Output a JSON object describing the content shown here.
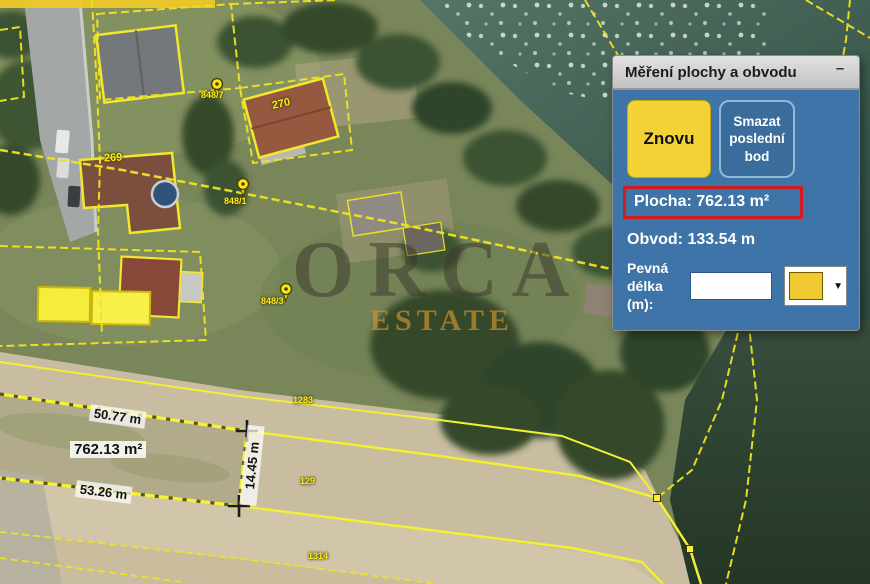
{
  "panel": {
    "title": "Měření plochy a obvodu",
    "minimize": "–",
    "again_button": "Znovu",
    "delete_button": "Smazat poslední bod",
    "area_text": "Plocha: 762.13 m²",
    "perimeter_text": "Obvod: 133.54 m",
    "fixed_length_label": "Pevná délka (m):",
    "fixed_length_value": "",
    "dropdown_arrow": "▼"
  },
  "map": {
    "watermark_line1": "ORCA",
    "watermark_line2": "ESTATE",
    "labels": {
      "top_edge": "50.77 m",
      "area": "762.13 m²",
      "bottom_edge": "53.26 m",
      "right_edge": "14.45 m"
    },
    "parcels": {
      "p270": "270",
      "p269": "269",
      "p848_7": "848/7",
      "p848_1": "848/1",
      "p848_3": "848/3",
      "p1283": "1283",
      "p129": "129",
      "p1314": "1314"
    }
  },
  "colors": {
    "panel_blue": "#3e74a7",
    "button_yellow": "#f2d234",
    "highlight_red": "#d11d1d",
    "parcel_line_yellow": "#efe420"
  }
}
